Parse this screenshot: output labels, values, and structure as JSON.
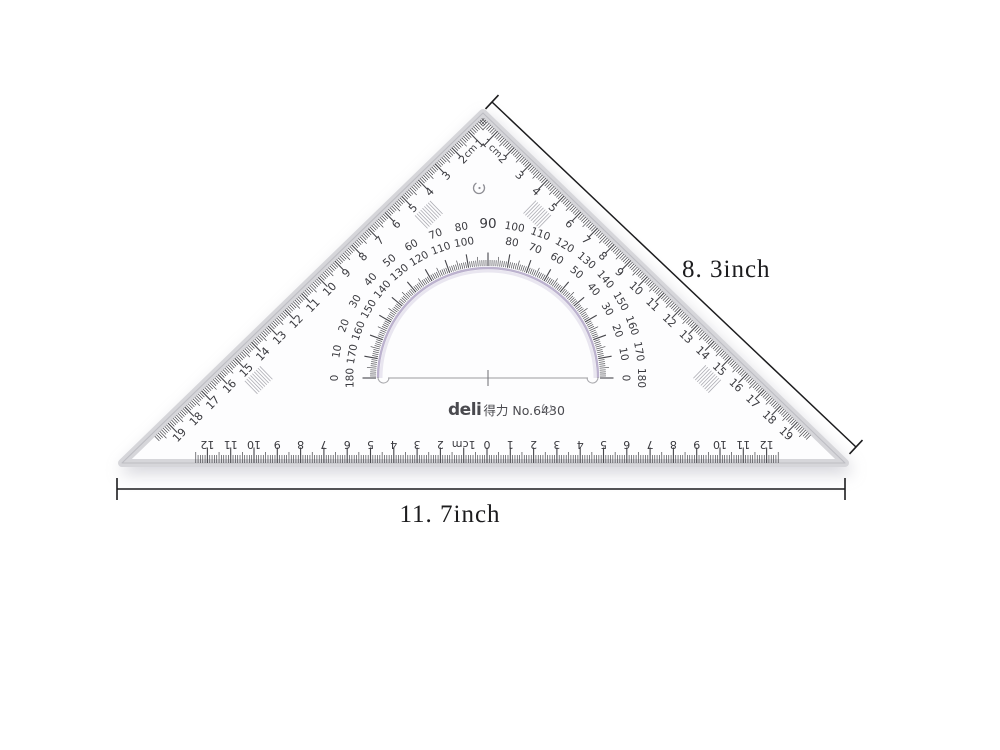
{
  "product": {
    "brand_logo": "deli",
    "brand_chinese": "得力",
    "model": "No.6430"
  },
  "dimensions": {
    "hypotenuse_label": "8. 3inch",
    "base_label": "11. 7inch"
  },
  "scales": {
    "slant_unit_label": "cm",
    "left_edge_labels": [
      "1",
      "2",
      "3",
      "4",
      "5",
      "6",
      "7",
      "8",
      "9",
      "10",
      "11",
      "12",
      "13",
      "14",
      "15",
      "16",
      "17",
      "18",
      "19"
    ],
    "right_edge_labels": [
      "1",
      "2",
      "3",
      "4",
      "5",
      "6",
      "7",
      "8",
      "9",
      "10",
      "11",
      "12",
      "13",
      "14",
      "15",
      "16",
      "17",
      "18",
      "19"
    ],
    "bottom_left_labels": [
      "1cm",
      "2",
      "3",
      "4",
      "5",
      "6",
      "7",
      "8",
      "9",
      "10",
      "11",
      "12"
    ],
    "bottom_center_label": "0",
    "bottom_right_labels": [
      "1",
      "2",
      "3",
      "4",
      "5",
      "6",
      "7",
      "8",
      "9",
      "10",
      "11",
      "12"
    ]
  },
  "protractor": {
    "pairs": [
      {
        "outer": "0",
        "inner": "180"
      },
      {
        "outer": "10",
        "inner": "170"
      },
      {
        "outer": "20",
        "inner": "160"
      },
      {
        "outer": "30",
        "inner": "150"
      },
      {
        "outer": "40",
        "inner": "140"
      },
      {
        "outer": "50",
        "inner": "130"
      },
      {
        "outer": "60",
        "inner": "120"
      },
      {
        "outer": "70",
        "inner": "110"
      },
      {
        "outer": "80",
        "inner": "100"
      },
      {
        "outer": "90",
        "inner": ""
      },
      {
        "outer": "100",
        "inner": "80"
      },
      {
        "outer": "110",
        "inner": "70"
      },
      {
        "outer": "120",
        "inner": "60"
      },
      {
        "outer": "130",
        "inner": "50"
      },
      {
        "outer": "140",
        "inner": "40"
      },
      {
        "outer": "150",
        "inner": "30"
      },
      {
        "outer": "160",
        "inner": "20"
      },
      {
        "outer": "170",
        "inner": "10"
      },
      {
        "outer": "180",
        "inner": "0"
      }
    ]
  },
  "colors": {
    "tick": "#46464b",
    "number": "#3a3a3f",
    "arc_edge": "#ab9fc2",
    "bevel": "#d6d6da",
    "outline": "#bdbdc3",
    "dimension": "#1c1c1e",
    "brand": "#4a4a4f",
    "hatch": "#9a9aa2"
  }
}
